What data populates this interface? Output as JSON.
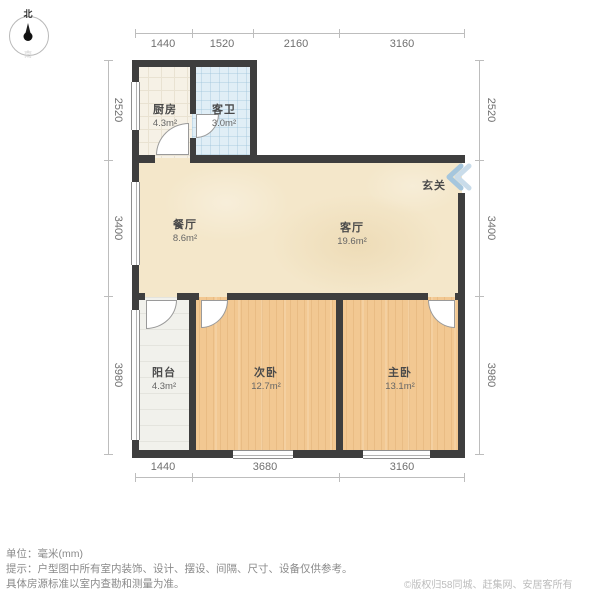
{
  "page": {
    "unit_label": "单位：毫米(mm)",
    "tip_line1": "提示：户型图中所有室内装饰、设计、摆设、间隔、尺寸、设备仅供参考。",
    "tip_line2": "具体房源标准以室内查勘和测量为准。",
    "copyright": "©版权归58同城、赶集网、安居客所有"
  },
  "compass": {
    "north_label": "北",
    "south_label": "南"
  },
  "rooms": [
    {
      "name": "厨房",
      "area": "4.3m²"
    },
    {
      "name": "客卫",
      "area": "3.0m²"
    },
    {
      "name": "餐厅",
      "area": "8.6m²"
    },
    {
      "name": "客厅",
      "area": "19.6m²"
    },
    {
      "name": "玄关",
      "area": ""
    },
    {
      "name": "阳台",
      "area": "4.3m²"
    },
    {
      "name": "次卧",
      "area": "12.7m²"
    },
    {
      "name": "主卧",
      "area": "13.1m²"
    }
  ],
  "dimensions": {
    "top": [
      "1440",
      "1520",
      "2160",
      "3160"
    ],
    "bottom": [
      "1440",
      "3680",
      "3160"
    ],
    "left": [
      "2520",
      "3400",
      "3980"
    ],
    "right": [
      "2520",
      "3400",
      "3980"
    ]
  },
  "colors": {
    "wall": "#3e3e3e",
    "wood_floor": "#f2c892",
    "bath_tile": "#e0eef6",
    "living_floor": "#f4e7ca",
    "entrance_arrow": "#a5c6dd"
  }
}
